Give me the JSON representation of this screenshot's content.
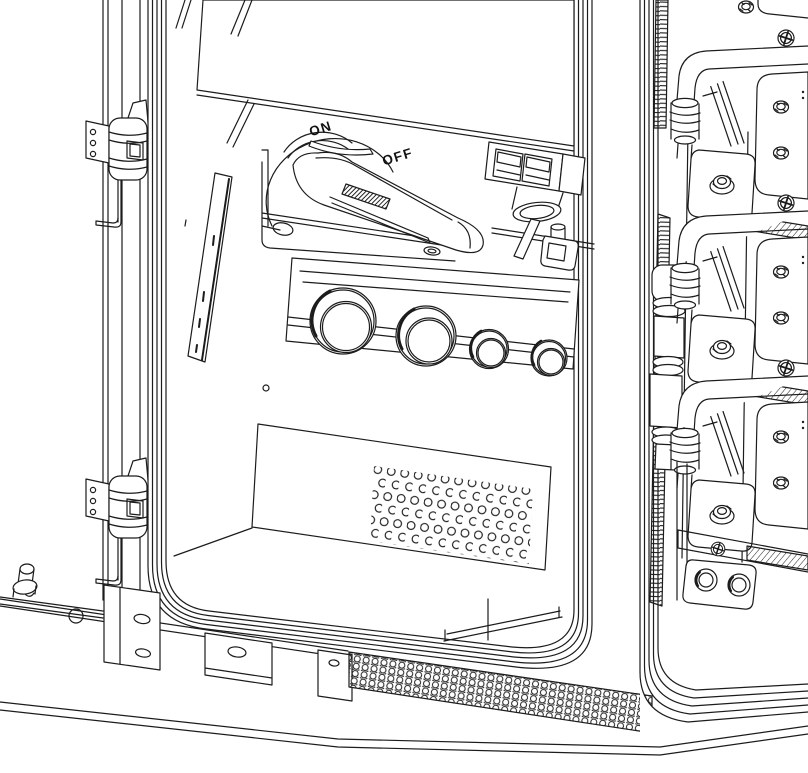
{
  "figure": {
    "switch": {
      "on_label": "ON",
      "off_label": "OFF"
    },
    "colors": {
      "line": "#1c1c1c",
      "background": "#ffffff"
    }
  }
}
